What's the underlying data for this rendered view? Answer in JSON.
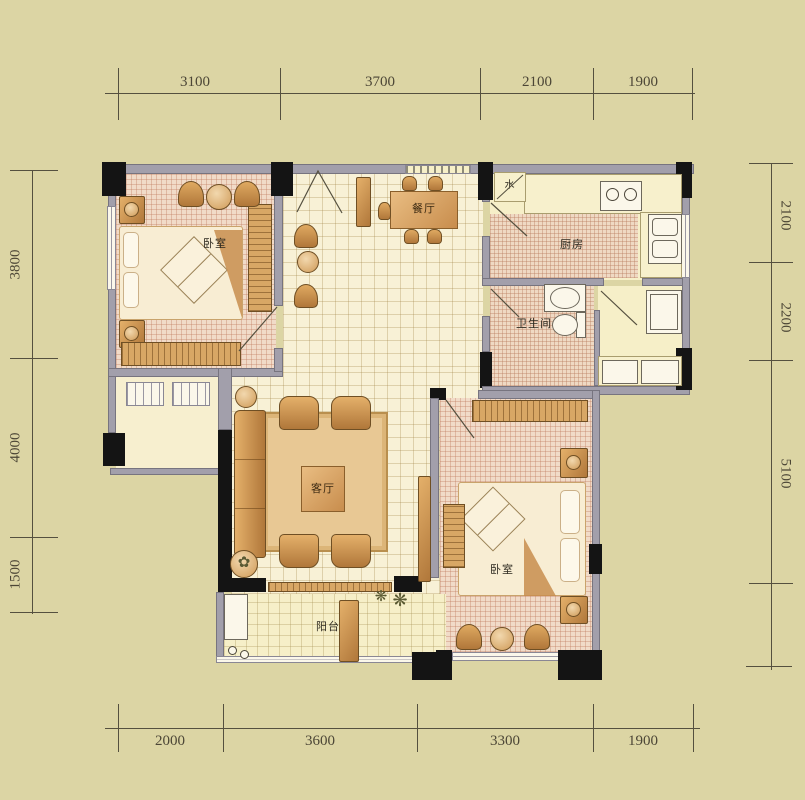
{
  "rooms": {
    "bedroom_top": "卧室",
    "dining": "餐厅",
    "kitchen": "厨房",
    "bathroom": "卫生间",
    "living": "客厅",
    "bedroom_bottom": "卧室",
    "balcony": "阳台"
  },
  "fixtures": {
    "water_meter": "水"
  },
  "dims": {
    "top": [
      "3100",
      "3700",
      "2100",
      "1900"
    ],
    "bottom": [
      "2000",
      "3600",
      "3300",
      "1900"
    ],
    "left": [
      "3800",
      "4000",
      "1500"
    ],
    "right": [
      "2100",
      "2200",
      "5100"
    ]
  },
  "icons": {
    "flower": "❋",
    "plant": "✿"
  },
  "colors": {
    "background": "#dcd5a4",
    "wall": "#a29fab",
    "column": "#141414",
    "floor_cream": "#f8f1d6",
    "floor_tile_pink": "#f1dbc8",
    "floor_pale_yellow": "#f6efc8",
    "furniture_brown": "#c88d4d",
    "dimension_text": "#4c4636"
  }
}
